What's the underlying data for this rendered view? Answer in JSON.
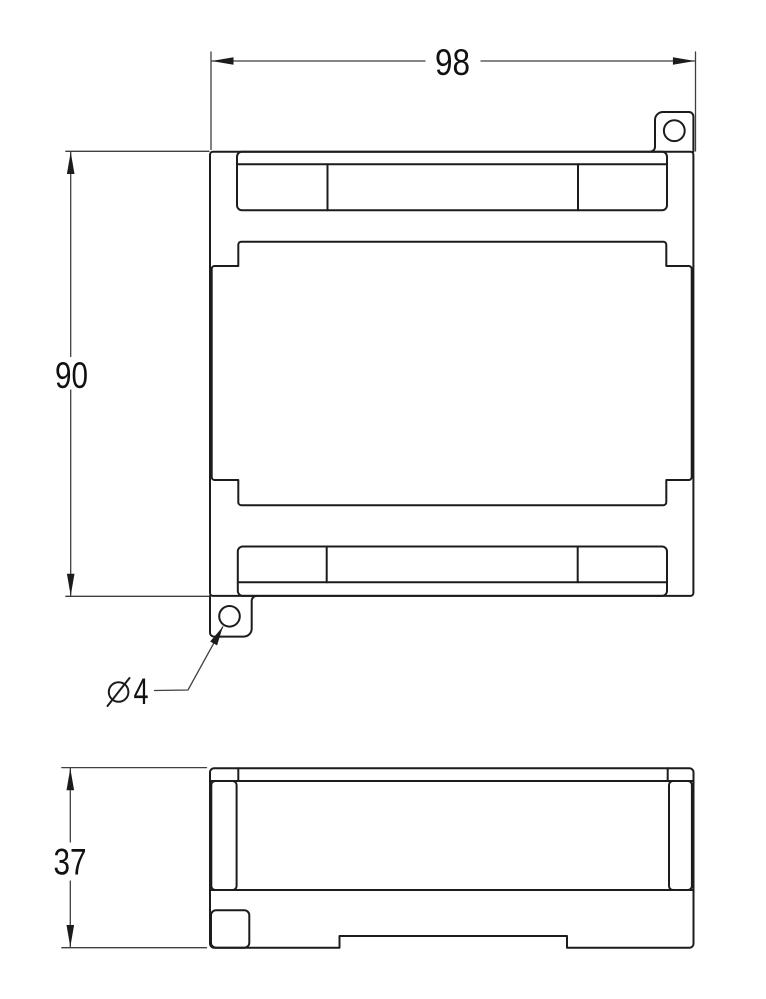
{
  "drawing": {
    "background_color": "#ffffff",
    "outline_color": "#1c1c1c",
    "dimension_color": "#3f3f3f",
    "text_color": "#111111",
    "dimensions": {
      "width": {
        "label": "98"
      },
      "height": {
        "label": "90"
      },
      "depth": {
        "label": "37"
      },
      "hole": {
        "symbol": "⌀",
        "value": "4",
        "label": "⌀4"
      }
    }
  }
}
